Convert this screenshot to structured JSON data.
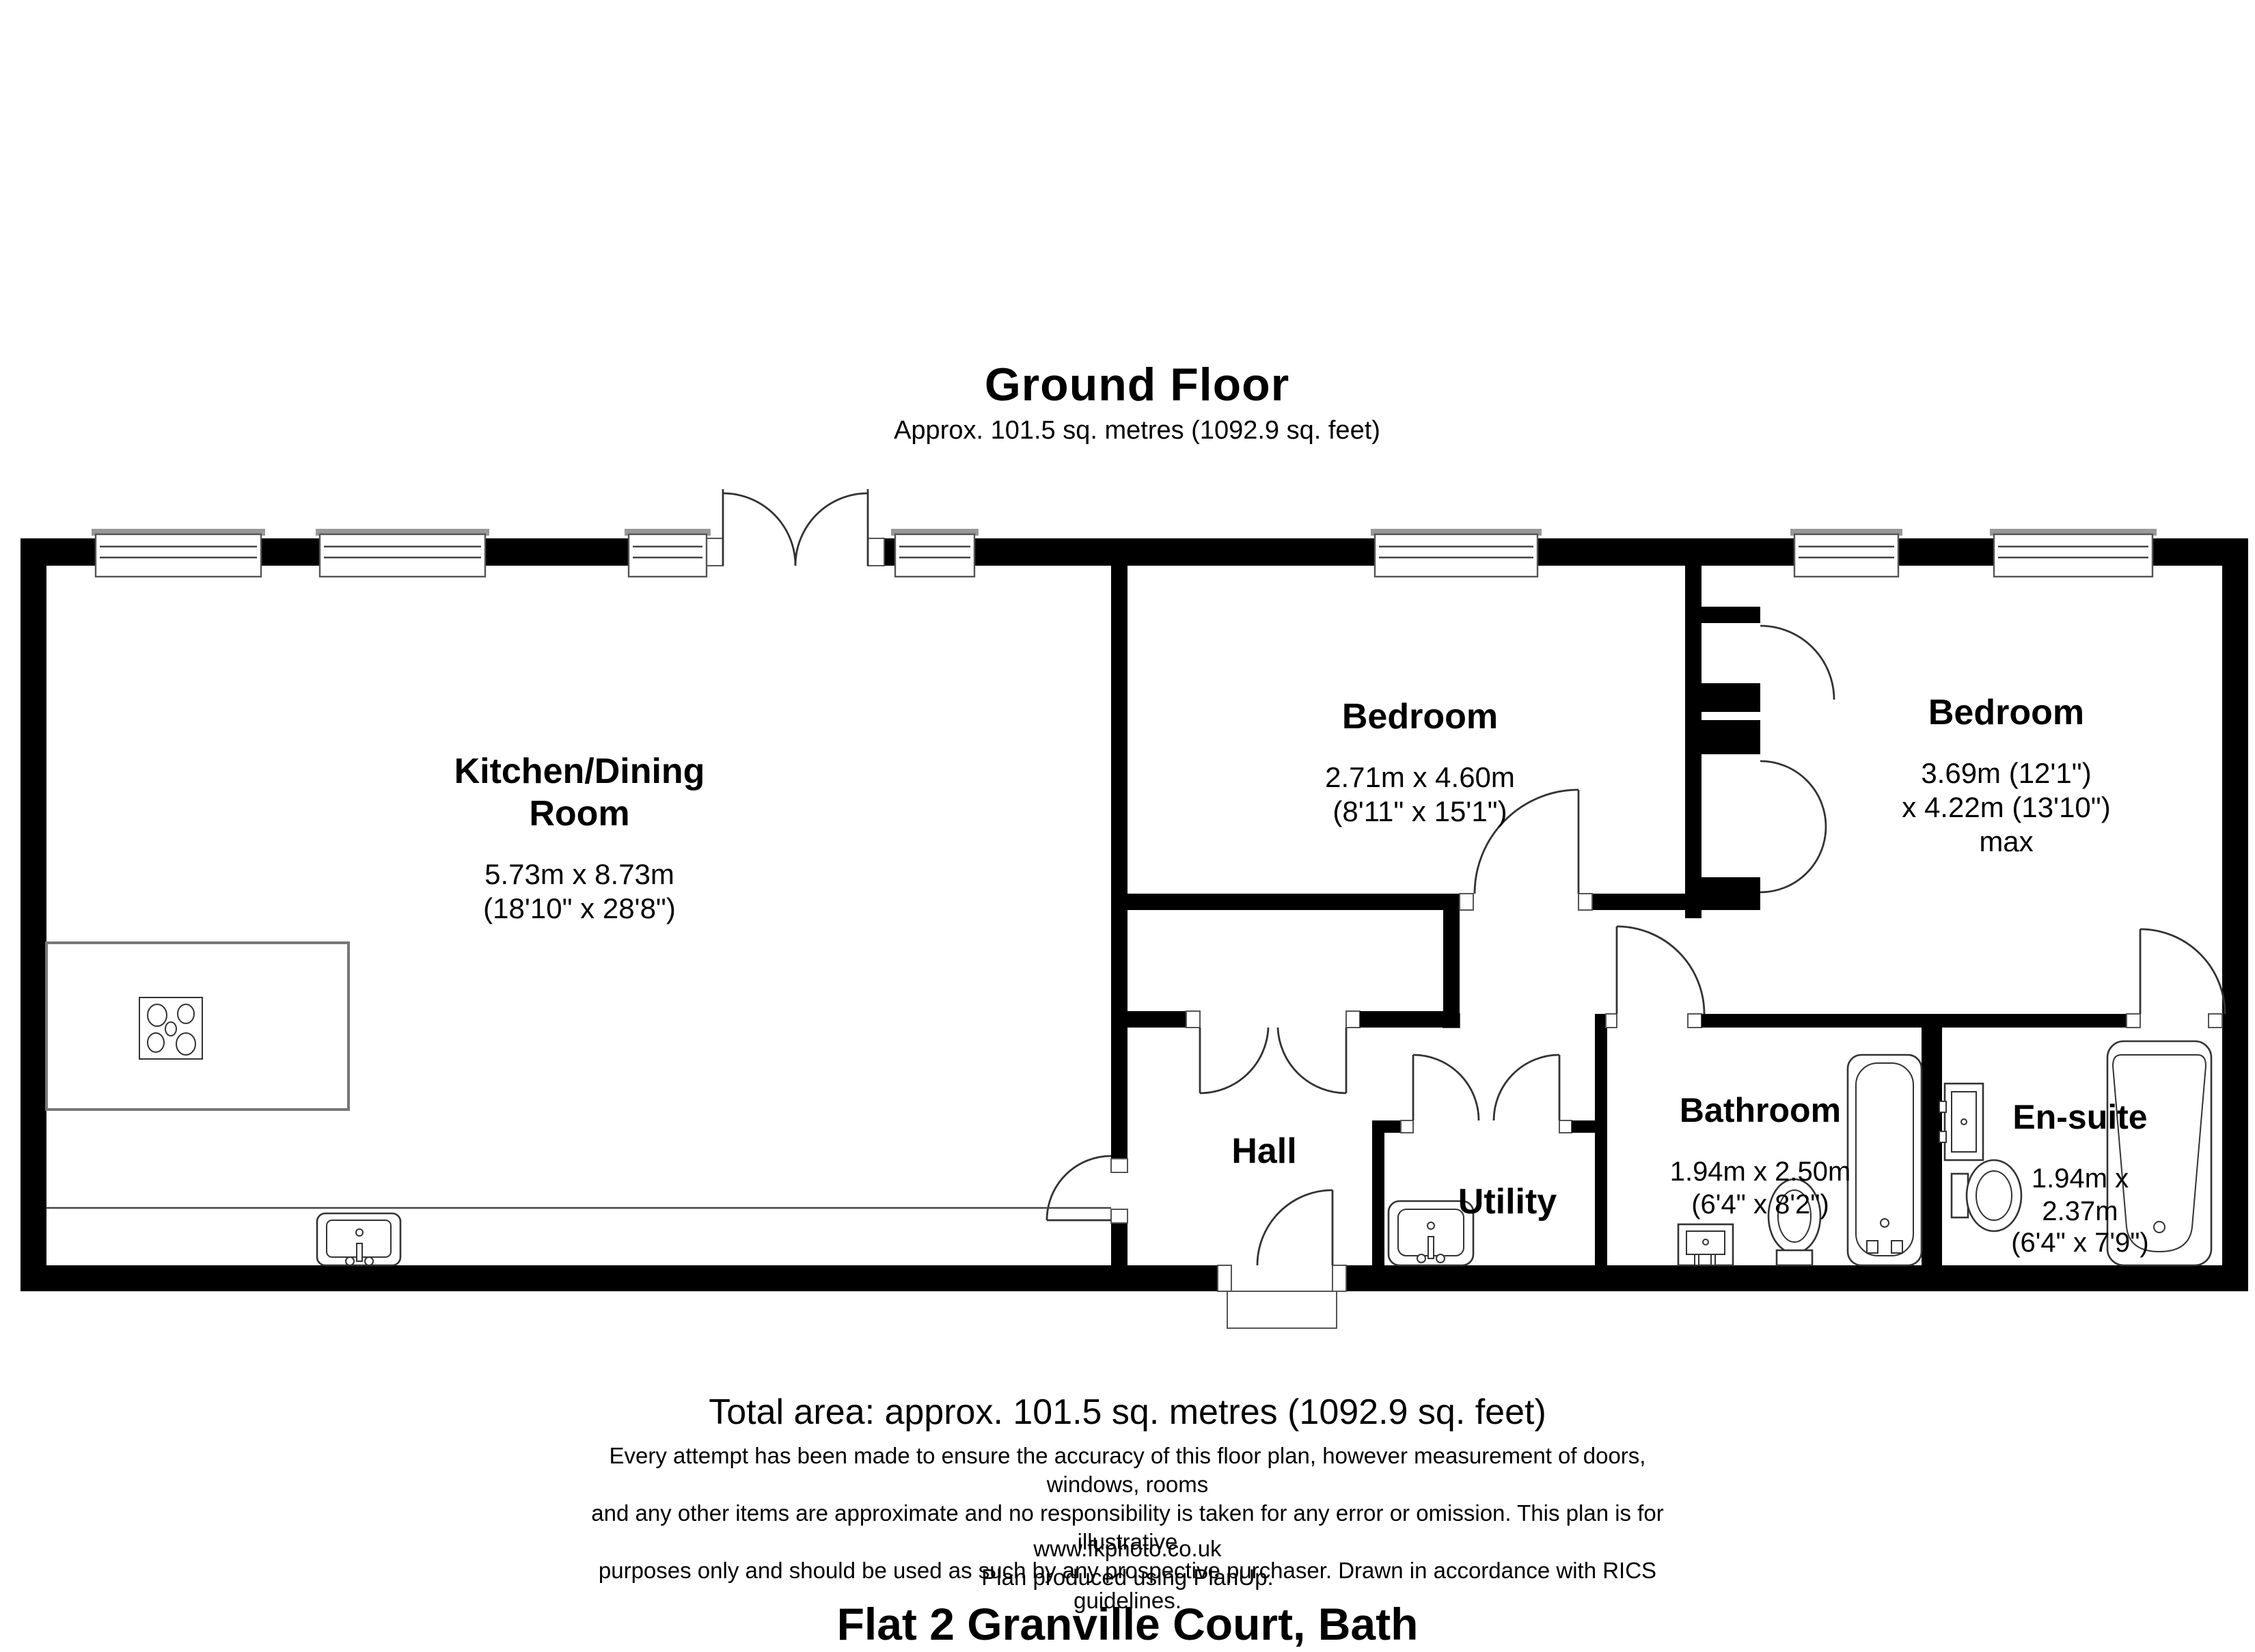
{
  "header": {
    "floor_title": "Ground Floor",
    "floor_area": "Approx. 101.5 sq. metres (1092.9 sq. feet)"
  },
  "rooms": {
    "kitchen": {
      "name": "Kitchen/Dining\nRoom",
      "dims": "5.73m x 8.73m\n(18'10\" x 28'8\")"
    },
    "bedroom1": {
      "name": "Bedroom",
      "dims": "2.71m x 4.60m\n(8'11\" x 15'1\")"
    },
    "bedroom2": {
      "name": "Bedroom",
      "dims": "3.69m (12'1\")\nx 4.22m (13'10\") max"
    },
    "hall": {
      "name": "Hall"
    },
    "utility": {
      "name": "Utility"
    },
    "bathroom": {
      "name": "Bathroom",
      "dims": "1.94m x 2.50m\n(6'4\" x 8'2\")"
    },
    "ensuite": {
      "name": "En-suite",
      "dims": "1.94m x 2.37m\n(6'4\" x 7'9\")"
    }
  },
  "footer": {
    "total_area": "Total area: approx. 101.5 sq. metres (1092.9 sq. feet)",
    "disclaimer": "Every attempt has been made to ensure the accuracy of this floor plan, however measurement of doors, windows, rooms\nand any other items are approximate and no responsibility is taken for any error or omission. This plan is for illustrative\npurposes only and should be used as such by any prospective purchaser. Drawn in accordance with RICS guidelines.",
    "website": "www.fkphoto.co.uk",
    "software_credit": "Plan produced using PlanUp.",
    "property_title": "Flat 2 Granville Court, Bath"
  },
  "fixtures": [
    "hob-icon",
    "kitchen-sink-icon",
    "utility-sink-icon",
    "bathroom-sink-icon",
    "bathroom-toilet-icon",
    "bathroom-bath-icon",
    "ensuite-sink-icon",
    "ensuite-toilet-icon",
    "ensuite-bath-icon",
    "window-icon",
    "door-swing-icon"
  ],
  "colors": {
    "wall": "#000000",
    "line": "#333333",
    "window_cap": "#999999"
  }
}
